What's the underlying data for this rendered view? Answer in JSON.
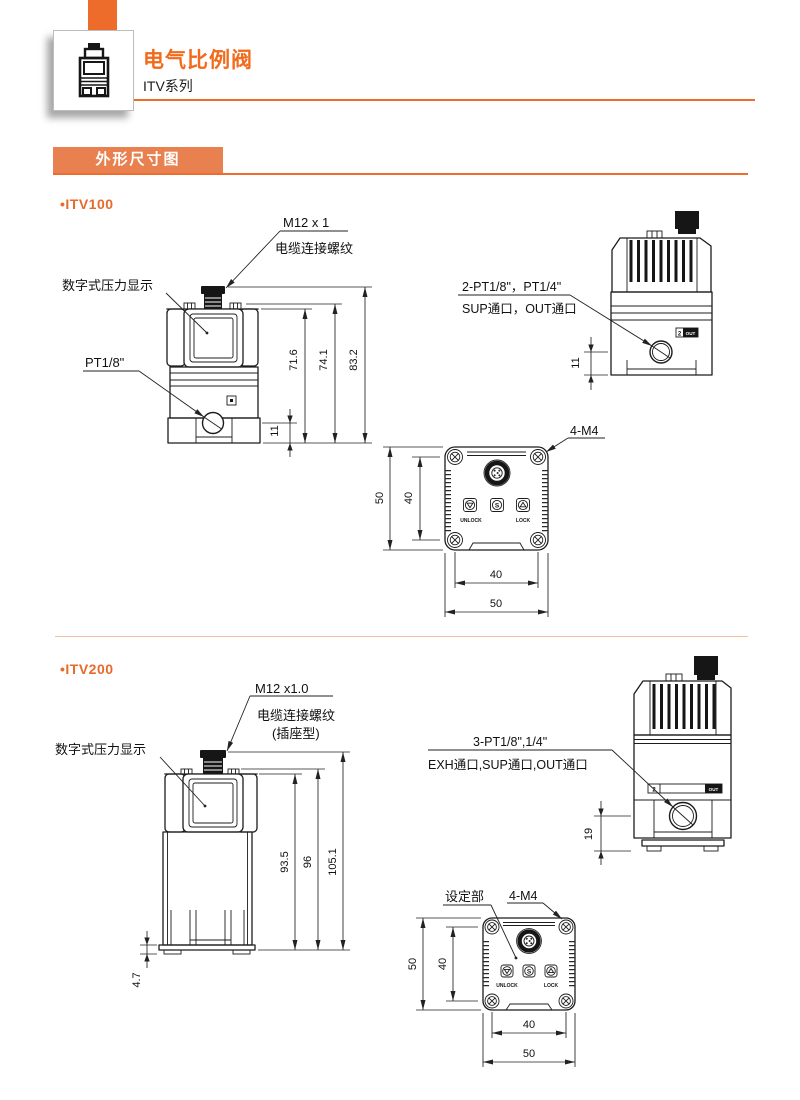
{
  "header": {
    "title": "电气比例阀",
    "subtitle": "ITV系列"
  },
  "section": {
    "title": "外形尺寸图"
  },
  "colors": {
    "orange": "#ee6c2b",
    "banner_orange": "#e9804f",
    "rule_orange": "#ed6c30",
    "divider_peach": "#f2c09a",
    "line": "#1c1c1c"
  },
  "v100": {
    "bullet": "•",
    "name": "ITV100",
    "front": {
      "thread": "M12 x 1",
      "thread_desc": "电缆连接螺纹",
      "display": "数字式压力显示",
      "port": "PT1/8\"",
      "d1": "71.6",
      "d2": "74.1",
      "d3": "83.2",
      "d4": "11"
    },
    "side": {
      "l1": "2-PT1/8\"，PT1/4\"",
      "l2": "SUP通口，OUT通口",
      "tag2": "2",
      "tagout": "OUT",
      "d1": "11"
    },
    "top": {
      "screws": "4-M4",
      "unlock": "UNLOCK",
      "lock": "LOCK",
      "sbtn": "S",
      "dv1": "50",
      "dv2": "40",
      "dh1": "40",
      "dh2": "50"
    }
  },
  "v200": {
    "bullet": "•",
    "name": "ITV200",
    "front": {
      "thread": "M12 x1.0",
      "thread_desc": "电缆连接螺纹",
      "thread_type": "(插座型)",
      "display": "数字式压力显示",
      "d1": "93.5",
      "d2": "96",
      "d3": "105.1",
      "d4": "4.7"
    },
    "side": {
      "l1": "3-PT1/8\",1/4\"",
      "l2": "EXH通口,SUP通口,OUT通口",
      "tag2": "2",
      "tagout": "OUT",
      "d1": "19"
    },
    "top": {
      "setting": "设定部",
      "screws": "4-M4",
      "unlock": "UNLOCK",
      "lock": "LOCK",
      "sbtn": "S",
      "dv1": "50",
      "dv2": "40",
      "dh1": "40",
      "dh2": "50"
    }
  }
}
